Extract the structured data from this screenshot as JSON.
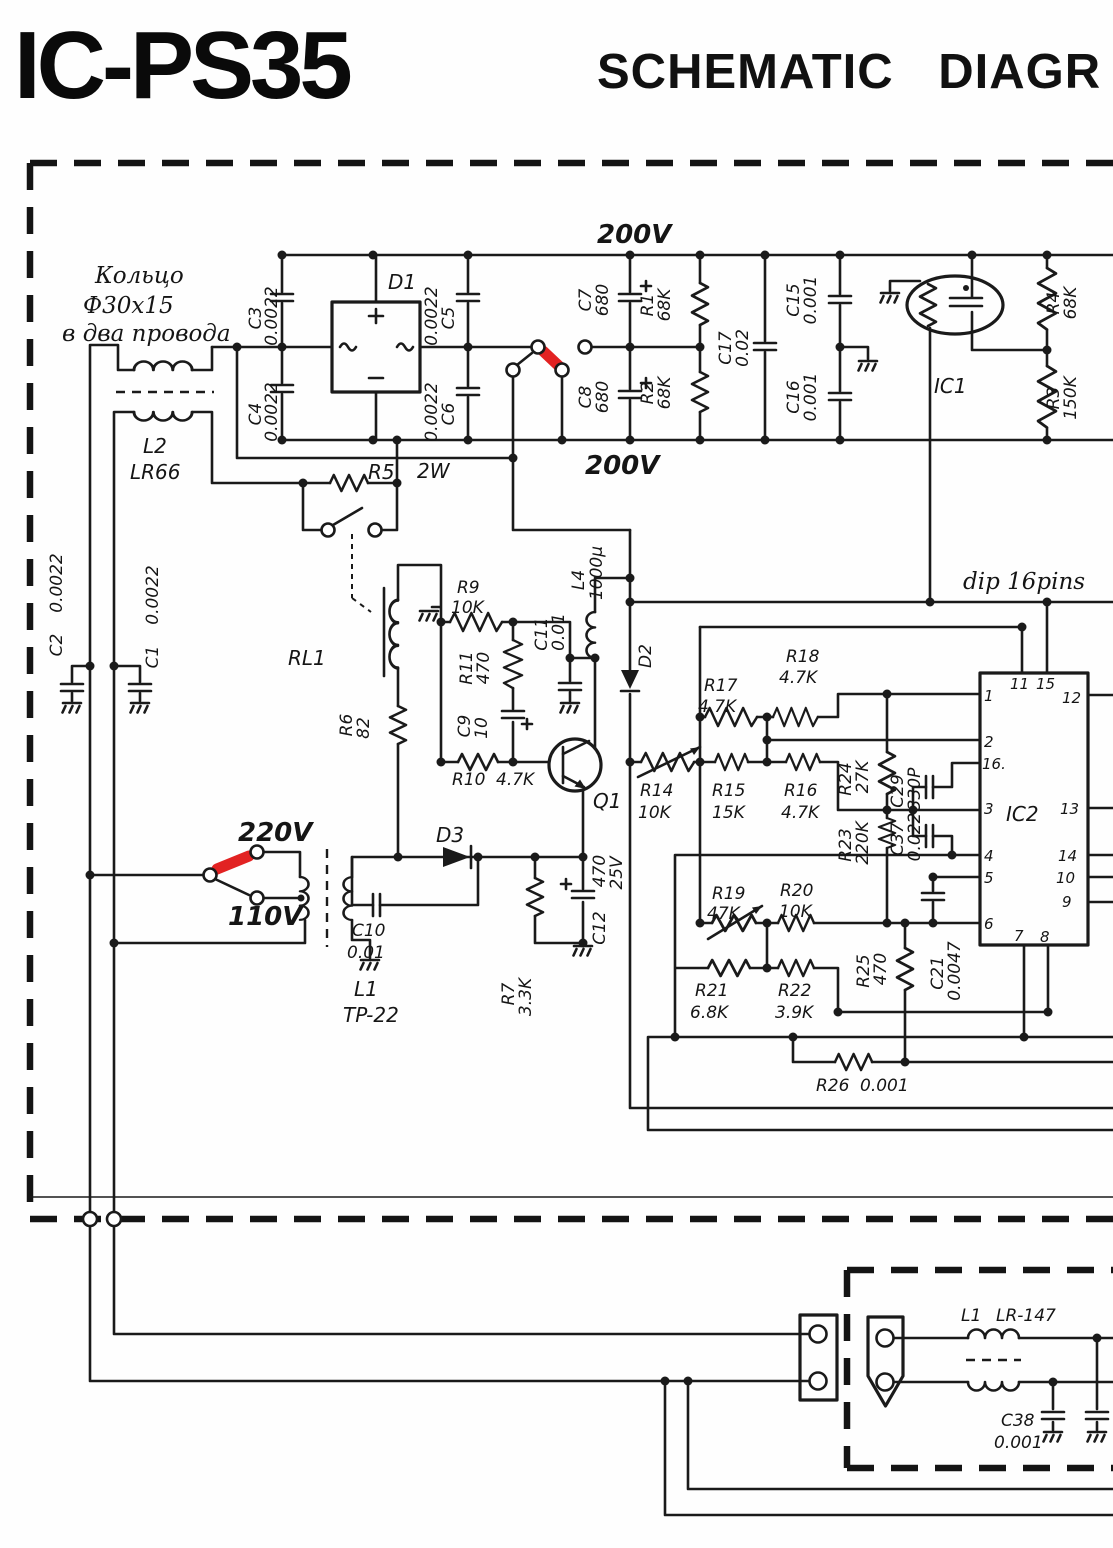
{
  "title": {
    "main": "IC-PS35",
    "sub": "SCHEMATIC DIAGR"
  },
  "annotations": {
    "ring1": "Кольцо",
    "ring2": "Ф30х15",
    "ring3": "в два провода",
    "v200top": "200V",
    "v200bot": "200V",
    "v220": "220V",
    "v110": "110V"
  },
  "ic2": {
    "label": "IC2",
    "package": "dip 16pins",
    "pins": {
      "p1": "1",
      "p2": "2",
      "p3": "3",
      "p4": "4",
      "p5": "5",
      "p6": "6",
      "p7": "7",
      "p8": "8",
      "p9": "9",
      "p10": "10",
      "p11": "11",
      "p12": "12",
      "p13": "13",
      "p14": "14",
      "p15": "15",
      "p16": "16."
    }
  },
  "components": {
    "c1": {
      "ref": "C1",
      "val": "0.0022"
    },
    "c2": {
      "ref": "C2",
      "val": "0.0022"
    },
    "c3": {
      "ref": "C3",
      "val": "0.0022"
    },
    "c4": {
      "ref": "C4",
      "val": "0.0022"
    },
    "c5": {
      "ref": "C5",
      "val": "0.0022"
    },
    "c6": {
      "ref": "C6",
      "val": "0.0022"
    },
    "c7": {
      "ref": "C7",
      "val": "680"
    },
    "c8": {
      "ref": "C8",
      "val": "680"
    },
    "c9": {
      "ref": "C9",
      "val": "10"
    },
    "c10": {
      "ref": "C10",
      "val": "0.01"
    },
    "c11": {
      "ref": "C11",
      "val": "0.01"
    },
    "c12": {
      "ref": "C12",
      "val": "470",
      "val2": "25V"
    },
    "c15": {
      "ref": "C15",
      "val": "0.001"
    },
    "c16": {
      "ref": "C16",
      "val": "0.001"
    },
    "c17": {
      "ref": "C17",
      "val": "0.02"
    },
    "c21": {
      "ref": "C21",
      "val": "0.0047"
    },
    "c29": {
      "ref": "C29",
      "val": "330P"
    },
    "c37": {
      "ref": "C37",
      "val": "0.022"
    },
    "c38": {
      "ref": "C38",
      "val": "0.001"
    },
    "d1": {
      "ref": "D1"
    },
    "d2": {
      "ref": "D2"
    },
    "d3": {
      "ref": "D3"
    },
    "q1": {
      "ref": "Q1"
    },
    "ic1": {
      "ref": "IC1"
    },
    "l2": {
      "ref": "L2",
      "val": "LR66"
    },
    "l4": {
      "ref": "L4",
      "val": "1000µ"
    },
    "l1_power": {
      "ref": "L1",
      "val": "TP-22"
    },
    "l1_rf": {
      "ref": "L1",
      "val": "LR-147"
    },
    "rl1": {
      "ref": "RL1"
    },
    "r1": {
      "ref": "R1",
      "val": "68K"
    },
    "r2": {
      "ref": "R2",
      "val": "68K"
    },
    "r3": {
      "ref": "R3",
      "val": "150K"
    },
    "r4": {
      "ref": "R4",
      "val": "68K"
    },
    "r5": {
      "ref": "R5",
      "val": "2W"
    },
    "r6": {
      "ref": "R6",
      "val": "82"
    },
    "r7": {
      "ref": "R7",
      "val": "3.3K"
    },
    "r9": {
      "ref": "R9",
      "val": "10K"
    },
    "r10": {
      "ref": "R10",
      "val": "4.7K"
    },
    "r11": {
      "ref": "R11",
      "val": "470"
    },
    "r14": {
      "ref": "R14",
      "val": "10K"
    },
    "r15": {
      "ref": "R15",
      "val": "15K"
    },
    "r16": {
      "ref": "R16",
      "val": "4.7K"
    },
    "r17": {
      "ref": "R17",
      "val": "4.7K"
    },
    "r18": {
      "ref": "R18",
      "val": "4.7K"
    },
    "r19": {
      "ref": "R19",
      "val": "47K"
    },
    "r20": {
      "ref": "R20",
      "val": "10K"
    },
    "r21": {
      "ref": "R21",
      "val": "6.8K"
    },
    "r22": {
      "ref": "R22",
      "val": "3.9K"
    },
    "r23": {
      "ref": "R23",
      "val": "220K"
    },
    "r24": {
      "ref": "R24",
      "val": "27K"
    },
    "r25": {
      "ref": "R25",
      "val": "470"
    },
    "r26": {
      "ref": "R26",
      "val": "0.001"
    }
  }
}
